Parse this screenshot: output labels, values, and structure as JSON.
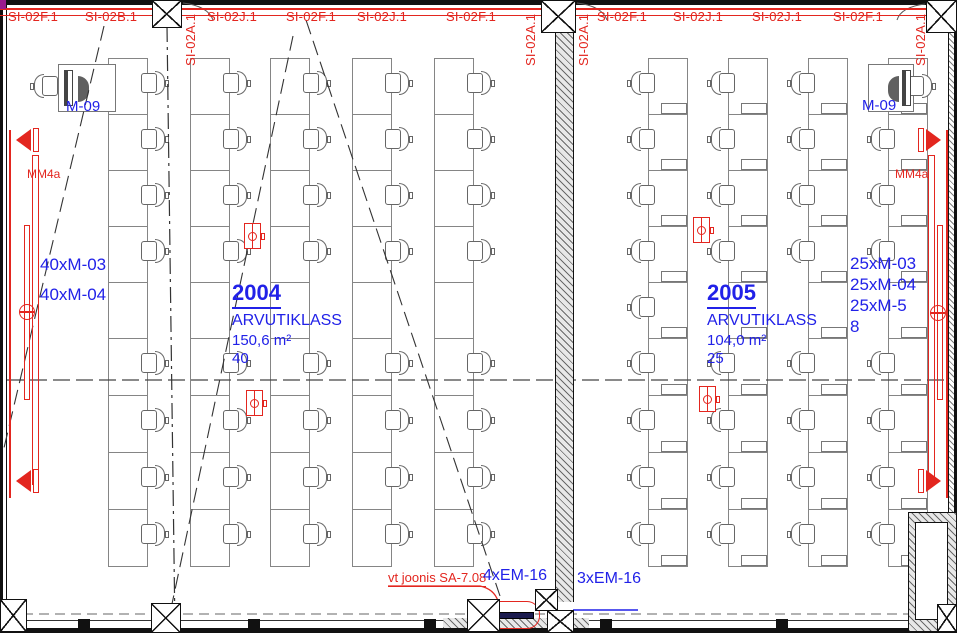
{
  "drawing": {
    "type": "architectural floor plan",
    "colors": {
      "red": "#e3261f",
      "blue": "#2121e8"
    },
    "top_axis_labels": [
      {
        "text": "SI-02F.1",
        "x": 8,
        "vertical": false
      },
      {
        "text": "SI-02B.1",
        "x": 85,
        "vertical": false
      },
      {
        "text": "SI-02A.1",
        "x": 184,
        "vertical": true
      },
      {
        "text": "SI-02J.1",
        "x": 207,
        "vertical": false
      },
      {
        "text": "SI-02F.1",
        "x": 286,
        "vertical": false
      },
      {
        "text": "SI-02J.1",
        "x": 357,
        "vertical": false
      },
      {
        "text": "SI-02F.1",
        "x": 446,
        "vertical": false
      },
      {
        "text": "SI-02A.1",
        "x": 524,
        "vertical": true
      },
      {
        "text": "SI-02A.1",
        "x": 577,
        "vertical": true
      },
      {
        "text": "SI-02F.1",
        "x": 597,
        "vertical": false
      },
      {
        "text": "SI-02J.1",
        "x": 673,
        "vertical": false
      },
      {
        "text": "SI-02J.1",
        "x": 752,
        "vertical": false
      },
      {
        "text": "SI-02F.1",
        "x": 833,
        "vertical": false
      },
      {
        "text": "SI-02A.1",
        "x": 914,
        "vertical": true
      }
    ],
    "rooms": [
      {
        "number": "2004",
        "name": "ARVUTIKLASS",
        "area": "150,6 m²",
        "capacity": "40",
        "teacher_station_label": "M-09",
        "equipment_labels": [
          "40xM-03",
          "40xM-04"
        ],
        "equipment_pos": {
          "x": 40,
          "y": 250,
          "line_h": 30
        },
        "label_pos": {
          "x": 232,
          "y": 281
        },
        "furniture": {
          "chair_back": "br",
          "desk_w": 40,
          "pcs": false,
          "columns": [
            {
              "x": 108,
              "upper": [
                1,
                2,
                3,
                4
              ],
              "lower": [
                1,
                2,
                3,
                4
              ]
            },
            {
              "x": 190,
              "upper": [
                1,
                2,
                3,
                4
              ],
              "lower": [
                1,
                2,
                3,
                4
              ]
            },
            {
              "x": 270,
              "upper": [
                1,
                2,
                3,
                4
              ],
              "lower": [
                1,
                2,
                3,
                4
              ]
            },
            {
              "x": 352,
              "upper": [
                1,
                2,
                3,
                4
              ],
              "lower": [
                1,
                2,
                3,
                4
              ]
            },
            {
              "x": 434,
              "upper": [
                1,
                2,
                3,
                4
              ],
              "lower": [
                1,
                2,
                3,
                4
              ]
            }
          ]
        }
      },
      {
        "number": "2005",
        "name": "ARVUTIKLASS",
        "area": "104,0 m²",
        "capacity": "25",
        "teacher_station_label": "M-09",
        "equipment_labels": [
          "25xM-03",
          "25xM-04",
          "25xM-5",
          "8"
        ],
        "equipment_pos": {
          "x": 850,
          "y": 253,
          "line_h": 21
        },
        "label_pos": {
          "x": 707,
          "y": 281
        },
        "furniture": {
          "chair_back": "bl",
          "desk_w": 40,
          "pcs": true,
          "columns": [
            {
              "x": 648,
              "upper": [
                1,
                2,
                3,
                4,
                5
              ],
              "lower": [
                1,
                2,
                3,
                4
              ]
            },
            {
              "x": 728,
              "upper": [
                1,
                2,
                3,
                4
              ],
              "lower": [
                1,
                2,
                3,
                4
              ]
            },
            {
              "x": 808,
              "upper": [
                1,
                2,
                3,
                4
              ],
              "lower": [
                1,
                2,
                3,
                4
              ]
            },
            {
              "x": 888,
              "upper": [
                2,
                3,
                4
              ],
              "lower": [
                1,
                2,
                3,
                4
              ]
            }
          ]
        }
      }
    ],
    "floor_boxes": [
      {
        "x": 244,
        "y": 223
      },
      {
        "x": 246,
        "y": 390
      },
      {
        "x": 693,
        "y": 217
      },
      {
        "x": 699,
        "y": 386
      }
    ],
    "wall_labels": {
      "left_mm": "MM4a",
      "right_mm": "MM4a"
    },
    "bottom_labels": {
      "em16_left": "4xEM-16",
      "em16_right": "3xEM-16",
      "ref_note": "vt joonis SA-7.08"
    }
  }
}
